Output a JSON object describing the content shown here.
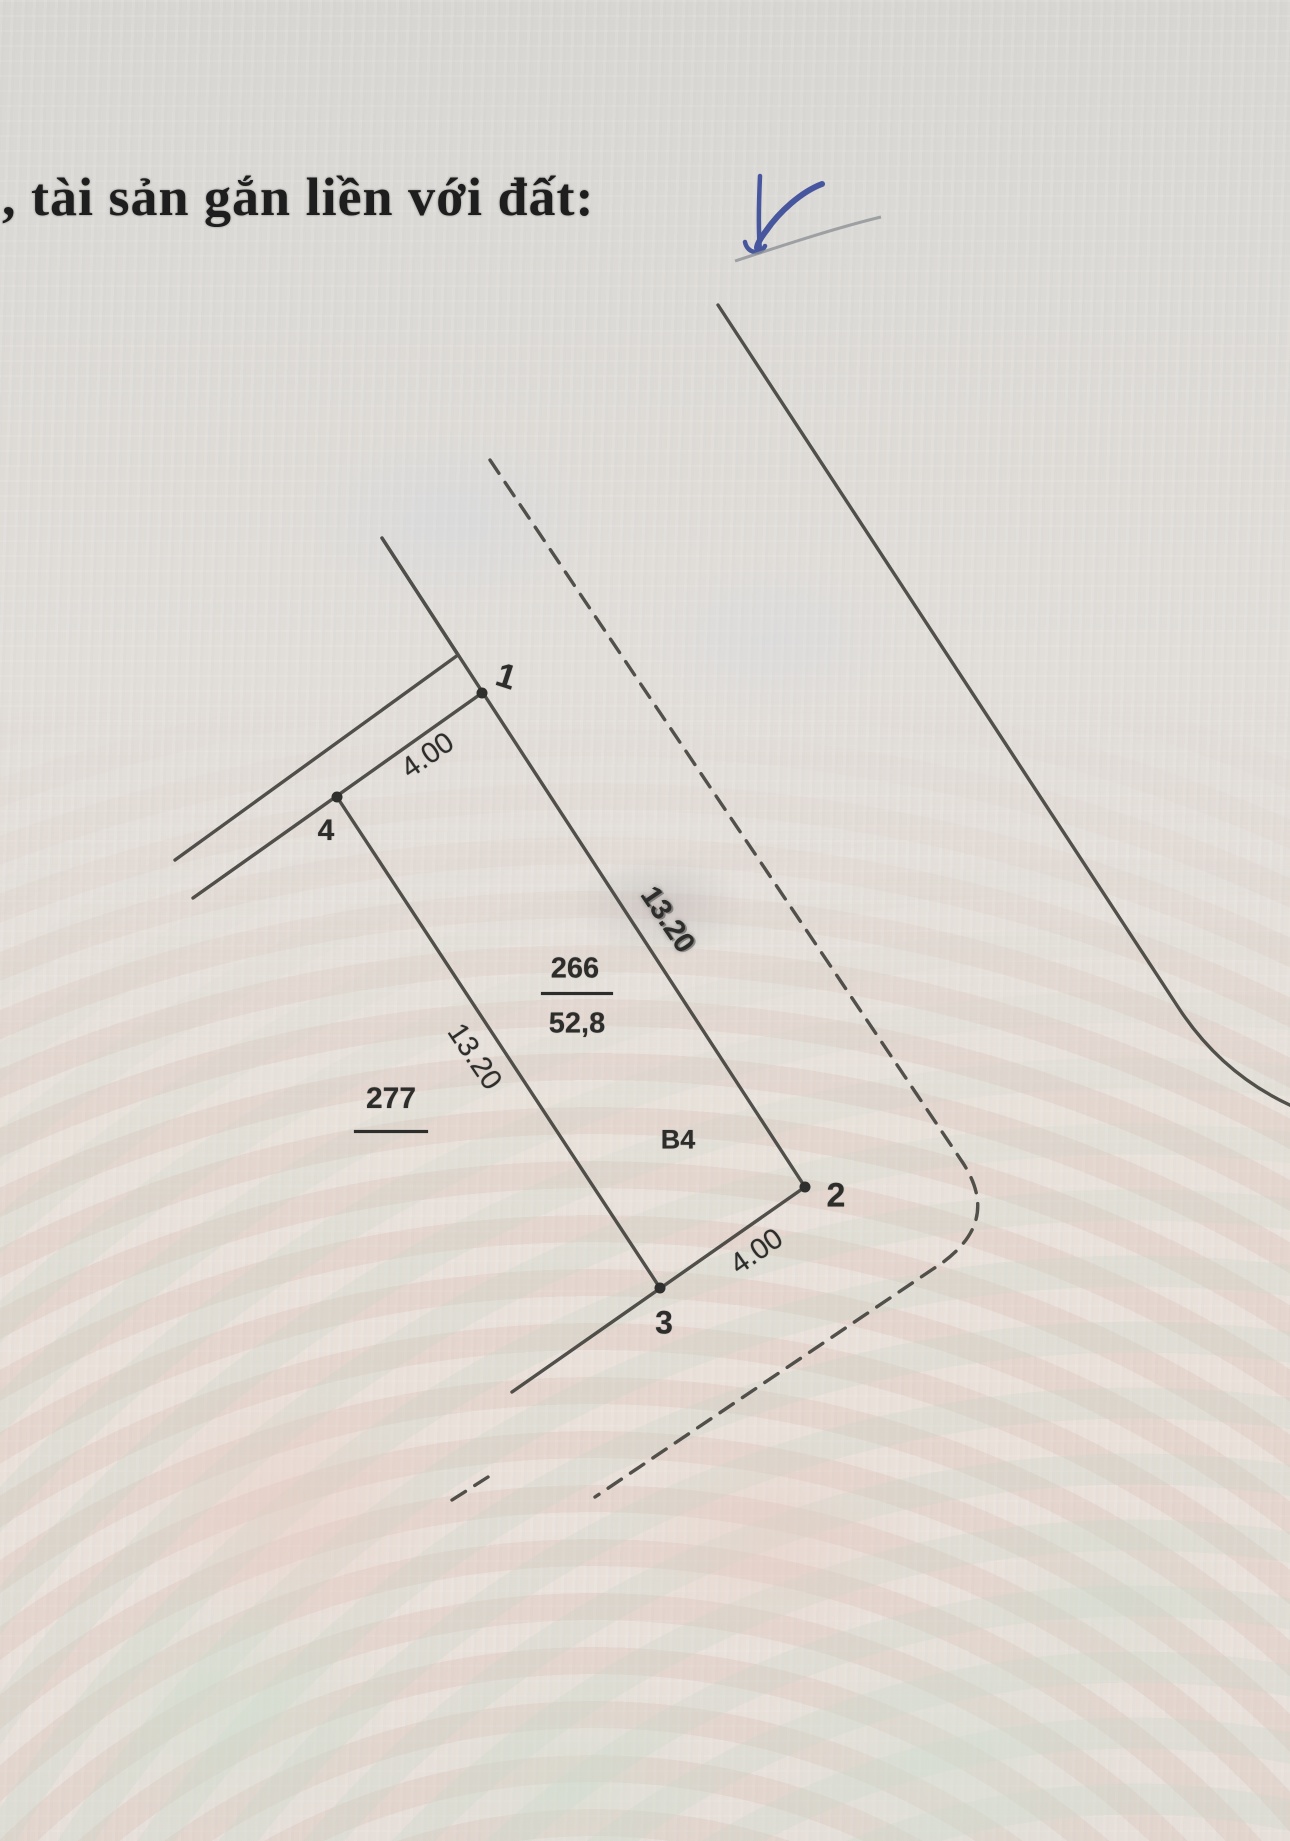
{
  "header": {
    "title_fragment": ", tài sản gắn liền với đất:",
    "scribble_icon": "blue-handwritten-check-scribble"
  },
  "diagram": {
    "parcel": {
      "plot_number": "266",
      "area": "52,8",
      "block_label": "B4"
    },
    "adjacent_plot_number": "277",
    "vertex_labels": {
      "v1": "1",
      "v2": "2",
      "v3": "3",
      "v4": "4"
    },
    "dimensions": {
      "edge_v4_v1": "4.00",
      "edge_v4_v3": "13.20",
      "edge_v1_v2": "13.20",
      "edge_v3_v2": "4.00"
    }
  }
}
